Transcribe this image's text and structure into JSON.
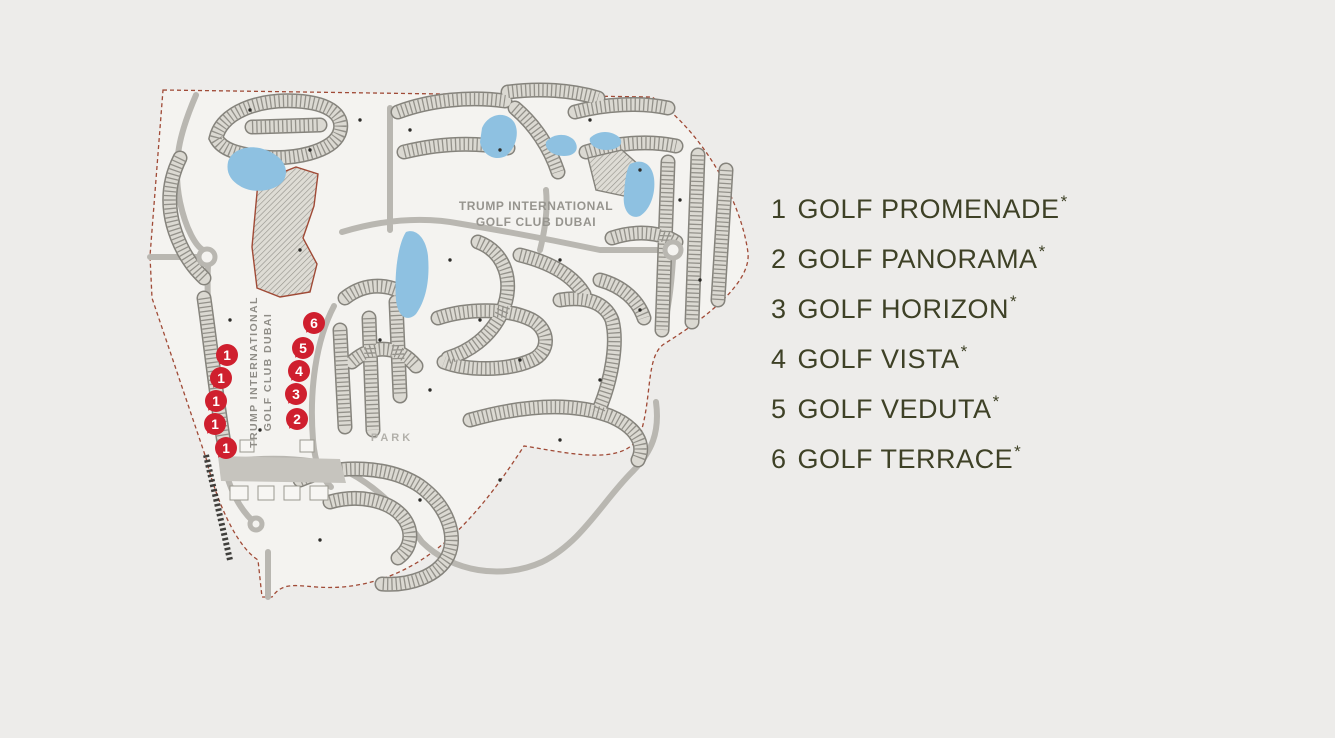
{
  "page": {
    "background": "#edecea"
  },
  "legend": {
    "text_color": "#3e4126",
    "items": [
      {
        "number": "1",
        "name": "GOLF PROMENADE",
        "suffix": "*"
      },
      {
        "number": "2",
        "name": "GOLF PANORAMA",
        "suffix": "*"
      },
      {
        "number": "3",
        "name": "GOLF HORIZON",
        "suffix": "*"
      },
      {
        "number": "4",
        "name": "GOLF VISTA",
        "suffix": "*"
      },
      {
        "number": "5",
        "name": "GOLF VEDUTA",
        "suffix": "*"
      },
      {
        "number": "6",
        "name": "GOLF TERRACE",
        "suffix": "*"
      }
    ]
  },
  "map": {
    "labels": {
      "club_h1": "TRUMP INTERNATIONAL",
      "club_h2": "GOLF CLUB DUBAI",
      "club_v1": "TRUMP INTERNATIONAL",
      "club_v2": "GOLF CLUB DUBAI",
      "park": "PARK"
    },
    "markers": [
      {
        "label": "1",
        "x": 227,
        "y": 355
      },
      {
        "label": "1",
        "x": 221,
        "y": 378
      },
      {
        "label": "1",
        "x": 216,
        "y": 401
      },
      {
        "label": "1",
        "x": 215,
        "y": 424
      },
      {
        "label": "1",
        "x": 226,
        "y": 448
      },
      {
        "label": "2",
        "x": 297,
        "y": 419
      },
      {
        "label": "3",
        "x": 296,
        "y": 394
      },
      {
        "label": "4",
        "x": 299,
        "y": 371
      },
      {
        "label": "5",
        "x": 303,
        "y": 348
      },
      {
        "label": "6",
        "x": 314,
        "y": 323
      }
    ],
    "colors": {
      "marker": "#cf1f2e",
      "lake": "#8ec1e1",
      "road": "#b9b7b1",
      "boundary": "#a04a36",
      "railway": "#3f3e3b",
      "land": "#f4f3f0",
      "cluster_outline": "#85837c"
    }
  }
}
